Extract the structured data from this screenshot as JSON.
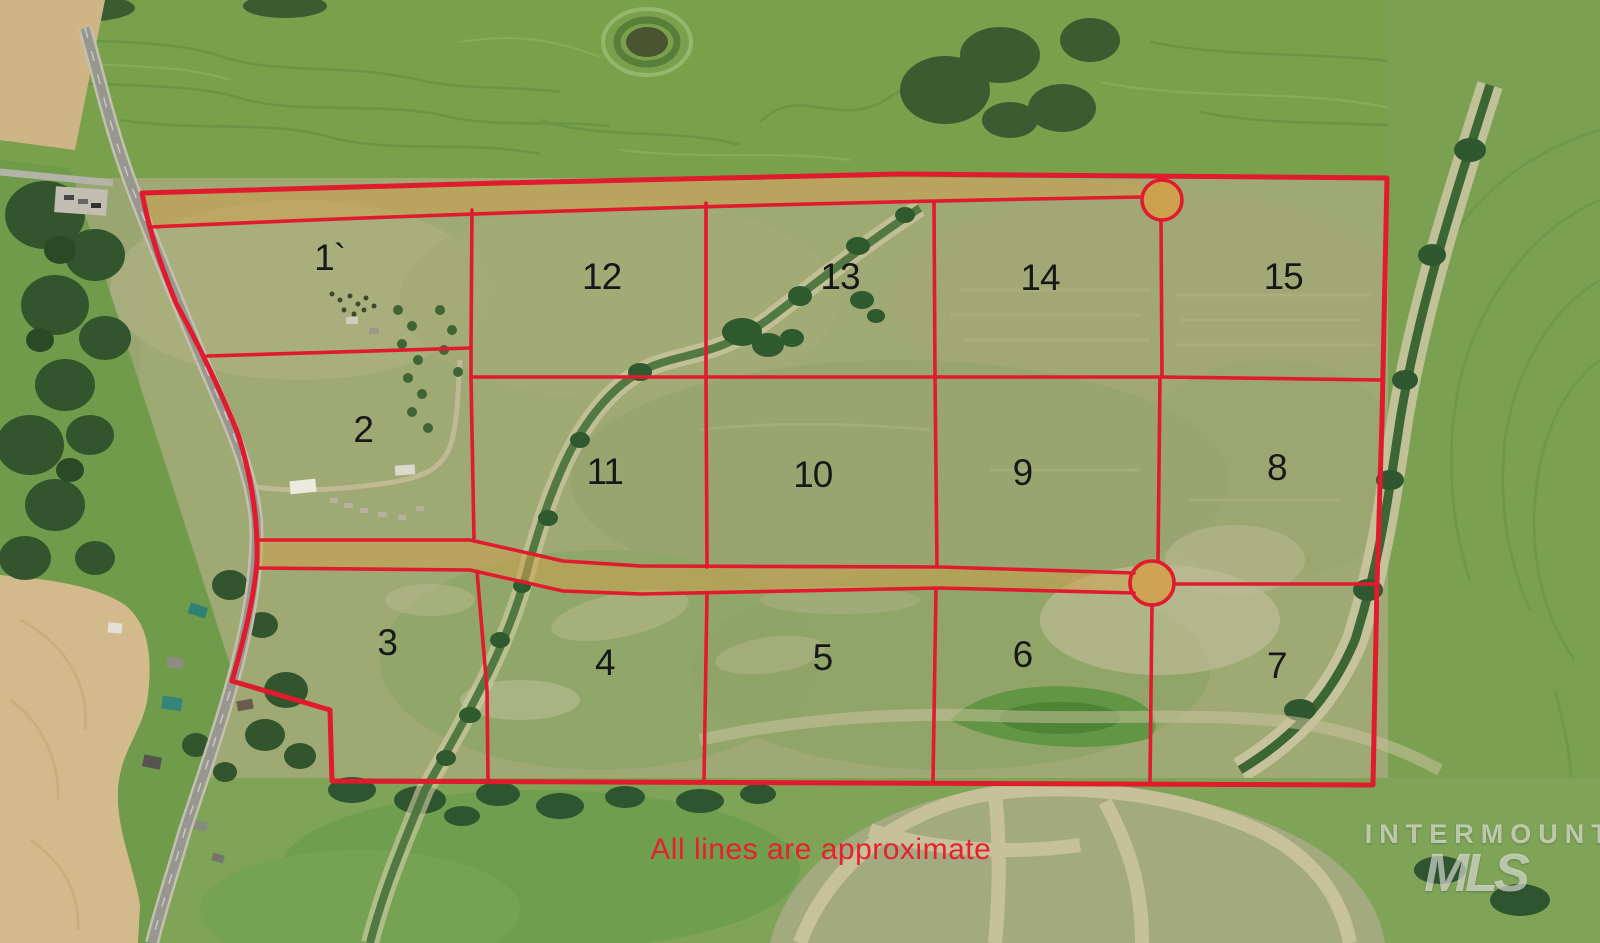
{
  "map": {
    "disclaimer": "All lines are approximate",
    "watermark": {
      "line1": "INTERMOUNTAIN",
      "line2": "MLS"
    },
    "colors": {
      "parcel_line": "#e01b2e",
      "road_easement_fill": "#d2a04a",
      "disclaimer_text": "#e8202e",
      "lot_number_text": "#171717"
    },
    "lots": [
      {
        "label": "1`",
        "x_pct": 20.6,
        "y_pct": 27.4
      },
      {
        "label": "2",
        "x_pct": 22.7,
        "y_pct": 45.6
      },
      {
        "label": "3",
        "x_pct": 24.2,
        "y_pct": 68.2
      },
      {
        "label": "4",
        "x_pct": 37.8,
        "y_pct": 70.3
      },
      {
        "label": "5",
        "x_pct": 51.4,
        "y_pct": 69.8
      },
      {
        "label": "6",
        "x_pct": 63.9,
        "y_pct": 69.5
      },
      {
        "label": "7",
        "x_pct": 79.8,
        "y_pct": 70.6
      },
      {
        "label": "8",
        "x_pct": 79.8,
        "y_pct": 49.6
      },
      {
        "label": "9",
        "x_pct": 63.9,
        "y_pct": 50.2
      },
      {
        "label": "10",
        "x_pct": 50.8,
        "y_pct": 50.4
      },
      {
        "label": "11",
        "x_pct": 37.8,
        "y_pct": 50.0
      },
      {
        "label": "12",
        "x_pct": 37.6,
        "y_pct": 29.4
      },
      {
        "label": "13",
        "x_pct": 52.5,
        "y_pct": 29.4
      },
      {
        "label": "14",
        "x_pct": 65.0,
        "y_pct": 29.5
      },
      {
        "label": "15",
        "x_pct": 80.2,
        "y_pct": 29.4
      }
    ]
  }
}
